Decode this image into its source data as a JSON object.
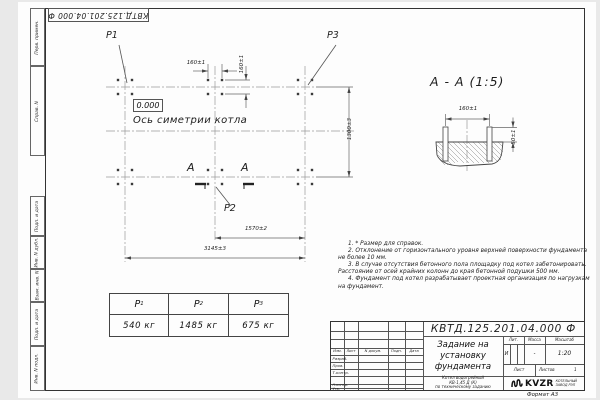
{
  "stamp_top": {
    "doc_number": "КВТД.125.201.04.000  Ф"
  },
  "sidebar": {
    "labels": [
      "Перв. примен.",
      "Справ. N",
      "Подп. и дата",
      "Инв. N дубл.",
      "Взам. инв. N",
      "Подп. и дата",
      "Инв. N подл."
    ]
  },
  "plan": {
    "p1_label": "Р1",
    "p2_label": "Р2",
    "p3_label": "Р3",
    "level_mark": "0.000",
    "axis_label": "Ось симетрии котла",
    "section_mark_left": "А",
    "section_mark_right": "А",
    "dim_bolt_pitch_x": "160±1",
    "dim_bolt_pitch_y": "160±1",
    "dim_row_spacing": "1300±3",
    "dim_mid_to_right": "1570±2",
    "dim_overall": "3145±3"
  },
  "section_view": {
    "title": "А - А (1:5)",
    "dim_bolt_pitch": "160±1",
    "dim_protrusion": "50±1"
  },
  "notes": {
    "items": [
      "1. * Размер для справок.",
      "2. Отклонение от горизонтального уровня верхней поверхности фундамента не более 10 мм.",
      "3. В случае отсутствия бетонного пола площадку под котел забетонировать. Расстояние от осей крайних колонн до края бетонной подушки 500 мм.",
      "4. Фундамент под котел разрабатывает проектная организация по нагрузкам на фундамент."
    ]
  },
  "load_table": {
    "columns": [
      {
        "symbol": "Р",
        "sub": "1",
        "value": "540 кг"
      },
      {
        "symbol": "Р",
        "sub": "2",
        "value": "1485 кг"
      },
      {
        "symbol": "Р",
        "sub": "3",
        "value": "675 кг"
      }
    ]
  },
  "title_block": {
    "doc_number": "КВТД.125.201.04.000  Ф",
    "title_lines": [
      "Задание на",
      "установку",
      "фундамента"
    ],
    "columns_header": [
      "Изм.",
      "Лист",
      "N докум.",
      "Подп.",
      "Дата"
    ],
    "row_labels": [
      "Разраб.",
      "Пров.",
      "Т.контр.",
      "Н.контр.",
      "Утв."
    ],
    "lit_label": "Лит.",
    "lit_value": "И",
    "mass_label": "Масса",
    "mass_value": "-",
    "scale_label": "Масштаб",
    "scale_value": "1:20",
    "sheet_label": "Лист",
    "sheets_label": "Листов",
    "sheets_value": "1",
    "product_lines": [
      "Котел водогрейный",
      "КВ-1,45 Д (К)",
      "по техническому заданию"
    ],
    "logo_name": "KVZR",
    "logo_caption_lines": [
      "КОТЕЛЬНЫЙ",
      "ЗАВОД РЭП"
    ]
  },
  "footer": {
    "format_note": "Формат А3"
  }
}
